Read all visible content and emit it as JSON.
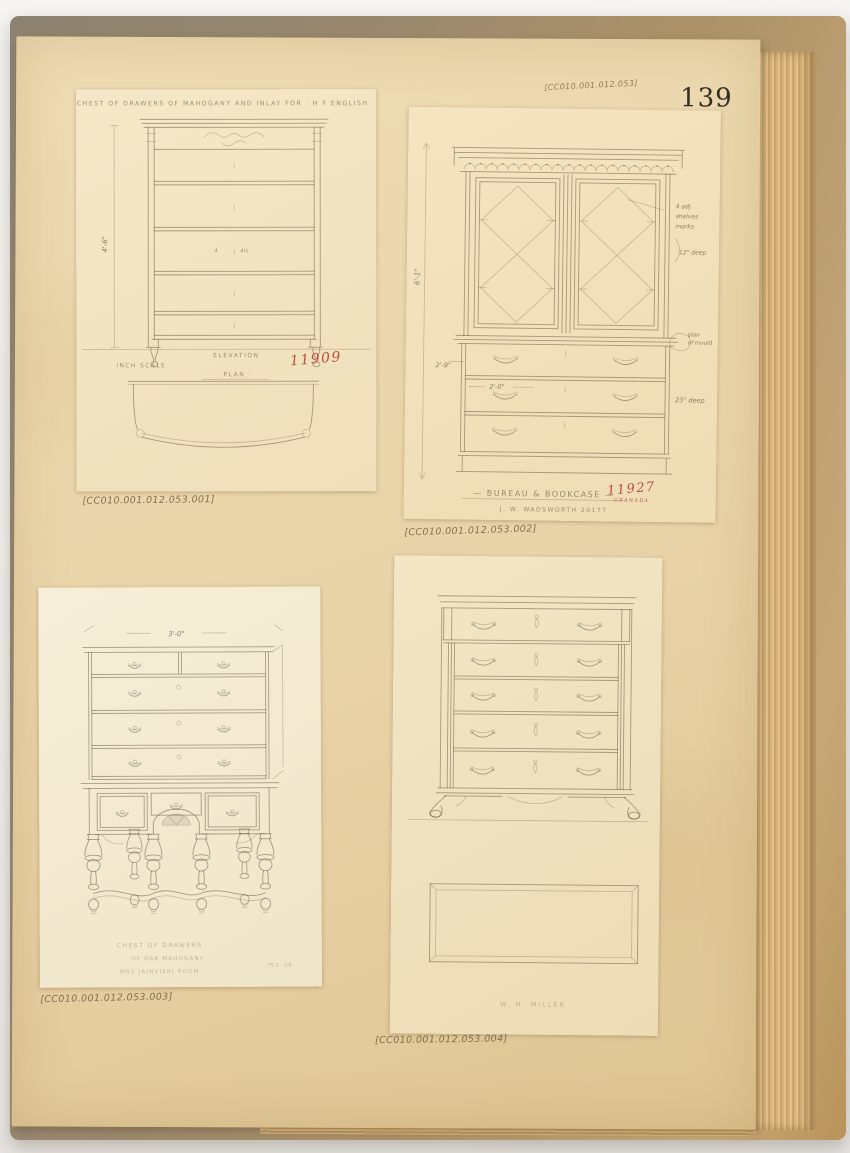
{
  "page": {
    "number": "139"
  },
  "captions": {
    "c1": "[CC010.001.012.053.001]",
    "c2": "[CC010.001.012.053.002]",
    "c3": "[CC010.001.012.053.003]",
    "c4": "[CC010.001.012.053.004]",
    "header2": "[CC010.001.012.053]"
  },
  "d1": {
    "title": "— CHEST OF DRAWERS OF MAHOGANY AND INLAY FOR · H F ENGLISH · —",
    "dim_height": "4'-6\"",
    "elevation": "ELEVATION",
    "scale": "INCH SCALE",
    "plan": "· PLAN ·",
    "number": "11909",
    "note_a": "4",
    "note_b": "4½"
  },
  "d2": {
    "dim_height": "6'-1\"",
    "dim_base": "2'-9\"",
    "dim_drawer": "2'-0\"",
    "note1a": "4 adj",
    "note1b": "shelves",
    "note1c": "marks",
    "note2": "12\" deep",
    "note3a": "plan",
    "note3b": "of mould",
    "note4": "23\" deep",
    "title": "— BUREAU & BOOKCASE —",
    "number": "11927",
    "subtitle": "GRANADA",
    "maker": "J. W. WADSWORTH   20177"
  },
  "d3": {
    "dim_width": "3'-0\"",
    "cap1": "CHEST OF DRAWERS",
    "cap2": "OF OAK MAHOGANY",
    "cap3": "MRS JAINVIERI ROOM",
    "cap4": "FS 2 · 1/8"
  },
  "d4": {
    "caption": "W. H. MILLER"
  }
}
